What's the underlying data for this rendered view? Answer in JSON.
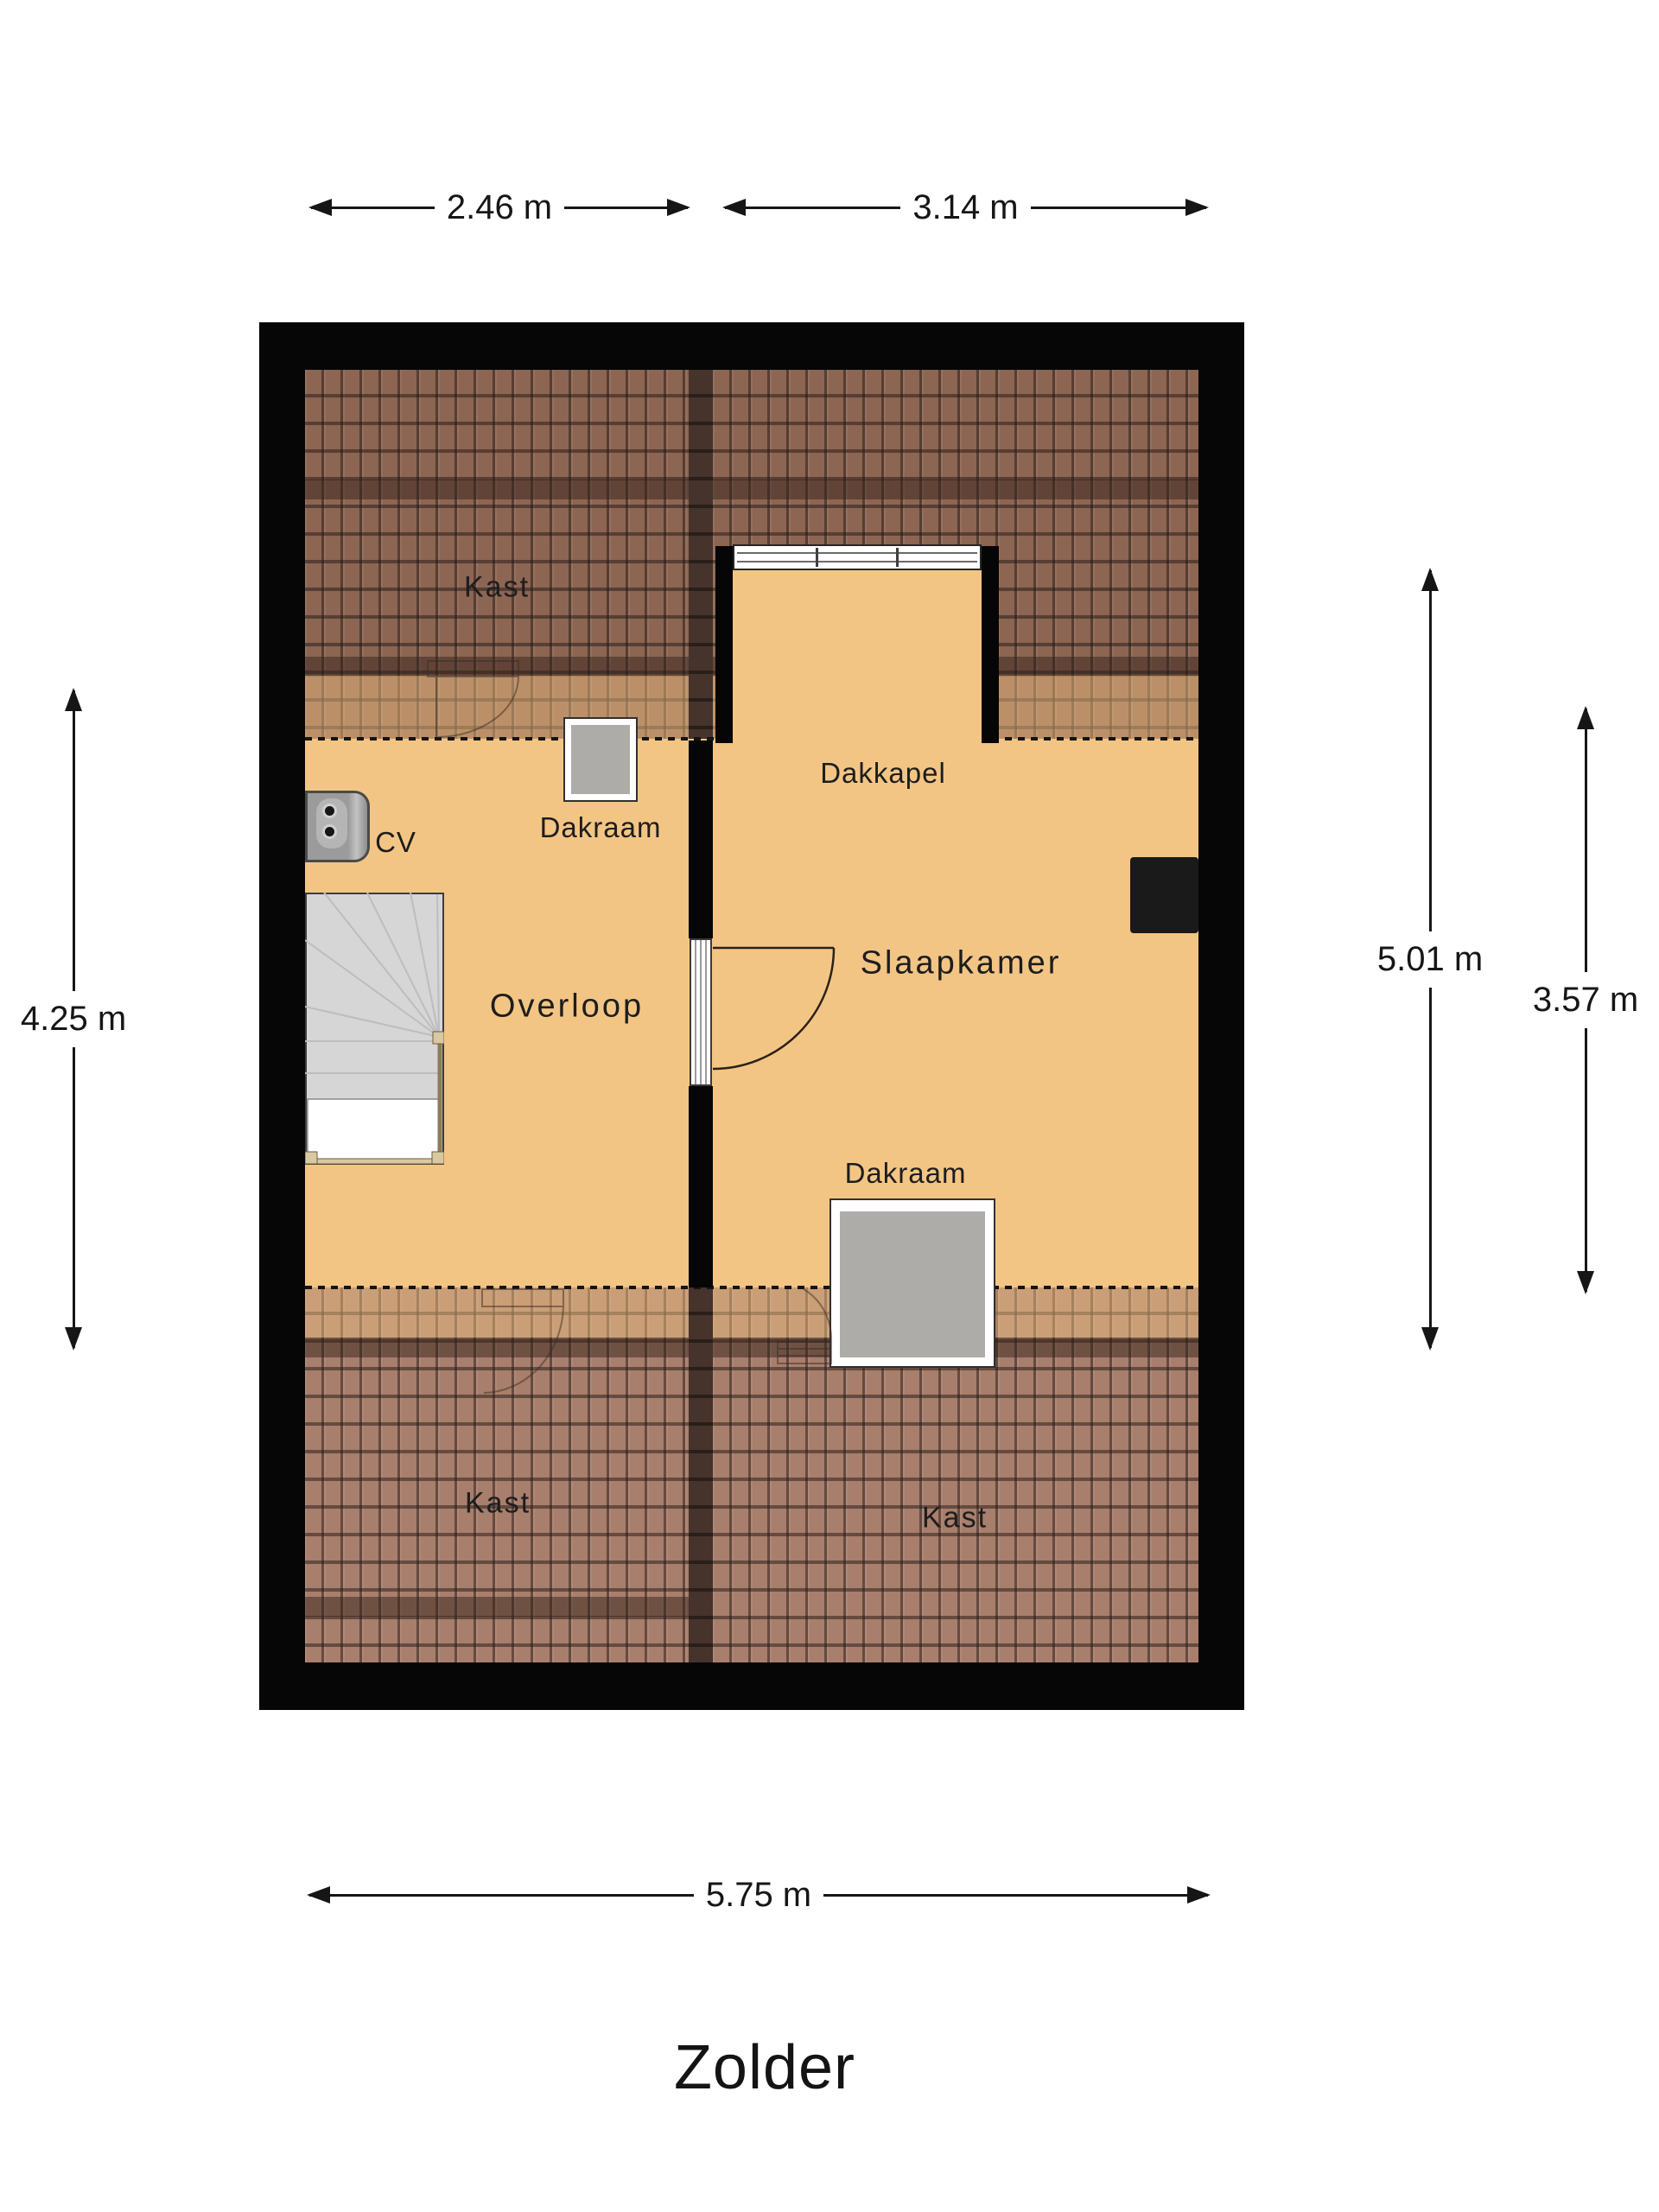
{
  "title": "Zolder",
  "dimensions": {
    "top": [
      {
        "label": "2.46 m"
      },
      {
        "label": "3.14 m"
      }
    ],
    "left": [
      {
        "label": "4.25 m"
      }
    ],
    "right": [
      {
        "label": "5.01 m"
      },
      {
        "label": "3.57 m"
      }
    ],
    "bottom": [
      {
        "label": "5.75 m"
      }
    ]
  },
  "rooms": {
    "kast_top": "Kast",
    "overloop": "Overloop",
    "slaapkamer": "Slaapkamer",
    "dakkapel": "Dakkapel",
    "kast_bottom_left": "Kast",
    "kast_bottom_right": "Kast"
  },
  "features": {
    "cv": "CV",
    "dakraam_overloop": "Dakraam",
    "dakraam_slaapkamer": "Dakraam"
  },
  "colors": {
    "floor": "#f3c584",
    "roof_upper": "#8c6553",
    "roof_lower": "#a87e6c",
    "wall": "#060606",
    "window_glass": "#aeaca9",
    "text": "#1d1d1d"
  }
}
